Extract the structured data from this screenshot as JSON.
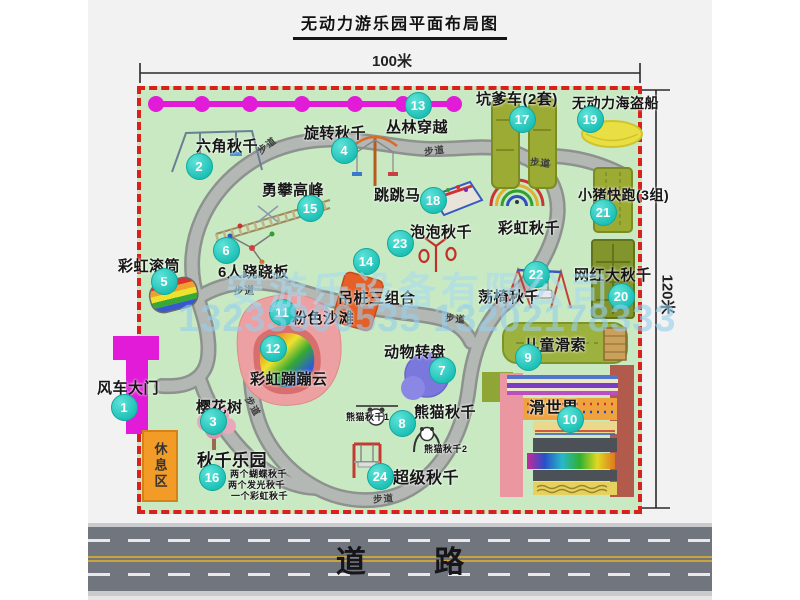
{
  "title": "无动力游乐园平面布局图",
  "dimension_labels": {
    "top": "100米",
    "right": "120米"
  },
  "road_label": "道 路",
  "rest_area_label": "休息区",
  "watermark": {
    "line1": "安游乐设备有限公司",
    "line2": "13233800535 13202178333"
  },
  "colors": {
    "map_green": "#c9e9c3",
    "border_red": "#da201a",
    "marker_teal": "#2ed3c6",
    "gate_magenta": "#e21bd9",
    "path_gray": "#aab0ac",
    "rest_orange": "#f29b27"
  },
  "attractions": [
    {
      "num": "1",
      "name": "风车大门",
      "marker": {
        "x": 124,
        "y": 407
      },
      "label": {
        "x": 97,
        "y": 377,
        "size": 15
      }
    },
    {
      "num": "2",
      "name": "六角秋千",
      "marker": {
        "x": 199,
        "y": 166
      },
      "label": {
        "x": 196,
        "y": 135,
        "size": 15
      }
    },
    {
      "num": "3",
      "name": "樱花树",
      "marker": {
        "x": 213,
        "y": 421
      },
      "label": {
        "x": 196,
        "y": 396,
        "size": 15
      }
    },
    {
      "num": "4",
      "name": "旋转秋千",
      "marker": {
        "x": 344,
        "y": 150
      },
      "label": {
        "x": 304,
        "y": 122,
        "size": 15
      }
    },
    {
      "num": "5",
      "name": "彩虹滚筒",
      "marker": {
        "x": 164,
        "y": 281
      },
      "label": {
        "x": 118,
        "y": 255,
        "size": 15
      }
    },
    {
      "num": "6",
      "name": "6人跷跷板",
      "marker": {
        "x": 226,
        "y": 250
      },
      "label": {
        "x": 218,
        "y": 261,
        "size": 15
      }
    },
    {
      "num": "7",
      "name": "动物转盘",
      "marker": {
        "x": 442,
        "y": 370
      },
      "label": {
        "x": 384,
        "y": 341,
        "size": 15
      }
    },
    {
      "num": "8",
      "name": "熊猫秋千",
      "marker": {
        "x": 402,
        "y": 423
      },
      "label": {
        "x": 414,
        "y": 401,
        "size": 15
      }
    },
    {
      "num": "9",
      "name": "儿童滑索",
      "marker": {
        "x": 528,
        "y": 357
      },
      "label": {
        "x": 524,
        "y": 334,
        "size": 15
      }
    },
    {
      "num": "10",
      "name": "滑世界",
      "marker": {
        "x": 570,
        "y": 419
      },
      "label": {
        "x": 529,
        "y": 394,
        "size": 16
      }
    },
    {
      "num": "11",
      "name": "粉色沙滩",
      "marker": {
        "x": 282,
        "y": 312
      },
      "label": {
        "x": 292,
        "y": 307,
        "size": 15
      }
    },
    {
      "num": "12",
      "name": "彩虹蹦蹦云",
      "marker": {
        "x": 273,
        "y": 348
      },
      "label": {
        "x": 250,
        "y": 368,
        "size": 15
      }
    },
    {
      "num": "13",
      "name": "丛林穿越",
      "marker": {
        "x": 418,
        "y": 105
      },
      "label": {
        "x": 386,
        "y": 116,
        "size": 15
      }
    },
    {
      "num": "14",
      "name": "吊桩三组合",
      "marker": {
        "x": 366,
        "y": 261
      },
      "label": {
        "x": 338,
        "y": 287,
        "size": 15
      }
    },
    {
      "num": "15",
      "name": "勇攀高峰",
      "marker": {
        "x": 310,
        "y": 208
      },
      "label": {
        "x": 262,
        "y": 179,
        "size": 15
      }
    },
    {
      "num": "16",
      "name": "秋千乐园",
      "marker": {
        "x": 212,
        "y": 477
      },
      "label": {
        "x": 197,
        "y": 446,
        "size": 17
      }
    },
    {
      "num": "17",
      "name": "坑爹车(2套)",
      "marker": {
        "x": 522,
        "y": 119
      },
      "label": {
        "x": 476,
        "y": 88,
        "size": 15
      }
    },
    {
      "num": "18",
      "name": "跳跳马",
      "marker": {
        "x": 433,
        "y": 200
      },
      "label": {
        "x": 374,
        "y": 184,
        "size": 15
      }
    },
    {
      "num": "19",
      "name": "无动力海盗船",
      "marker": {
        "x": 590,
        "y": 119
      },
      "label": {
        "x": 572,
        "y": 93,
        "size": 14
      }
    },
    {
      "num": "20",
      "name": "网红大秋千",
      "marker": {
        "x": 621,
        "y": 296
      },
      "label": {
        "x": 574,
        "y": 264,
        "size": 15
      }
    },
    {
      "num": "21",
      "name": "小猪快跑(3组)",
      "marker": {
        "x": 603,
        "y": 212
      },
      "label": {
        "x": 578,
        "y": 185,
        "size": 14
      }
    },
    {
      "num": "22",
      "name": "荡椅秋千",
      "marker": {
        "x": 536,
        "y": 274
      },
      "label": {
        "x": 478,
        "y": 286,
        "size": 15
      }
    },
    {
      "num": "23",
      "name": "泡泡秋千",
      "marker": {
        "x": 400,
        "y": 243
      },
      "label": {
        "x": 410,
        "y": 221,
        "size": 15
      }
    },
    {
      "num": "24",
      "name": "超级秋千",
      "marker": {
        "x": 380,
        "y": 476
      },
      "label": {
        "x": 393,
        "y": 464,
        "size": 16
      }
    }
  ],
  "extra_labels": [
    {
      "id": "rainbow-swing-label",
      "text": "彩虹秋千",
      "x": 498,
      "y": 217,
      "size": 15
    },
    {
      "id": "panda-swing-1-label",
      "text": "熊猫秋千1",
      "x": 346,
      "y": 410,
      "size": 9
    },
    {
      "id": "panda-swing-2-label",
      "text": "熊猫秋千2",
      "x": 424,
      "y": 442,
      "size": 9
    },
    {
      "id": "swing-park-note-1",
      "text": "两个蝴蝶秋千",
      "x": 230,
      "y": 467,
      "size": 9
    },
    {
      "id": "swing-park-note-2",
      "text": "两个发光秋千",
      "x": 228,
      "y": 478,
      "size": 9
    },
    {
      "id": "swing-park-note-3",
      "text": "一个彩虹秋千",
      "x": 231,
      "y": 489,
      "size": 9
    }
  ],
  "path_labels": [
    {
      "text": "步道",
      "x": 256,
      "y": 138,
      "rot": -38
    },
    {
      "text": "步道",
      "x": 424,
      "y": 143,
      "rot": -8
    },
    {
      "text": "步道",
      "x": 530,
      "y": 155,
      "rot": 6
    },
    {
      "text": "步道",
      "x": 234,
      "y": 283,
      "rot": 0
    },
    {
      "text": "步道",
      "x": 445,
      "y": 311,
      "rot": 6
    },
    {
      "text": "步道",
      "x": 243,
      "y": 399,
      "rot": 60
    },
    {
      "text": "步道",
      "x": 373,
      "y": 491,
      "rot": -4
    }
  ]
}
